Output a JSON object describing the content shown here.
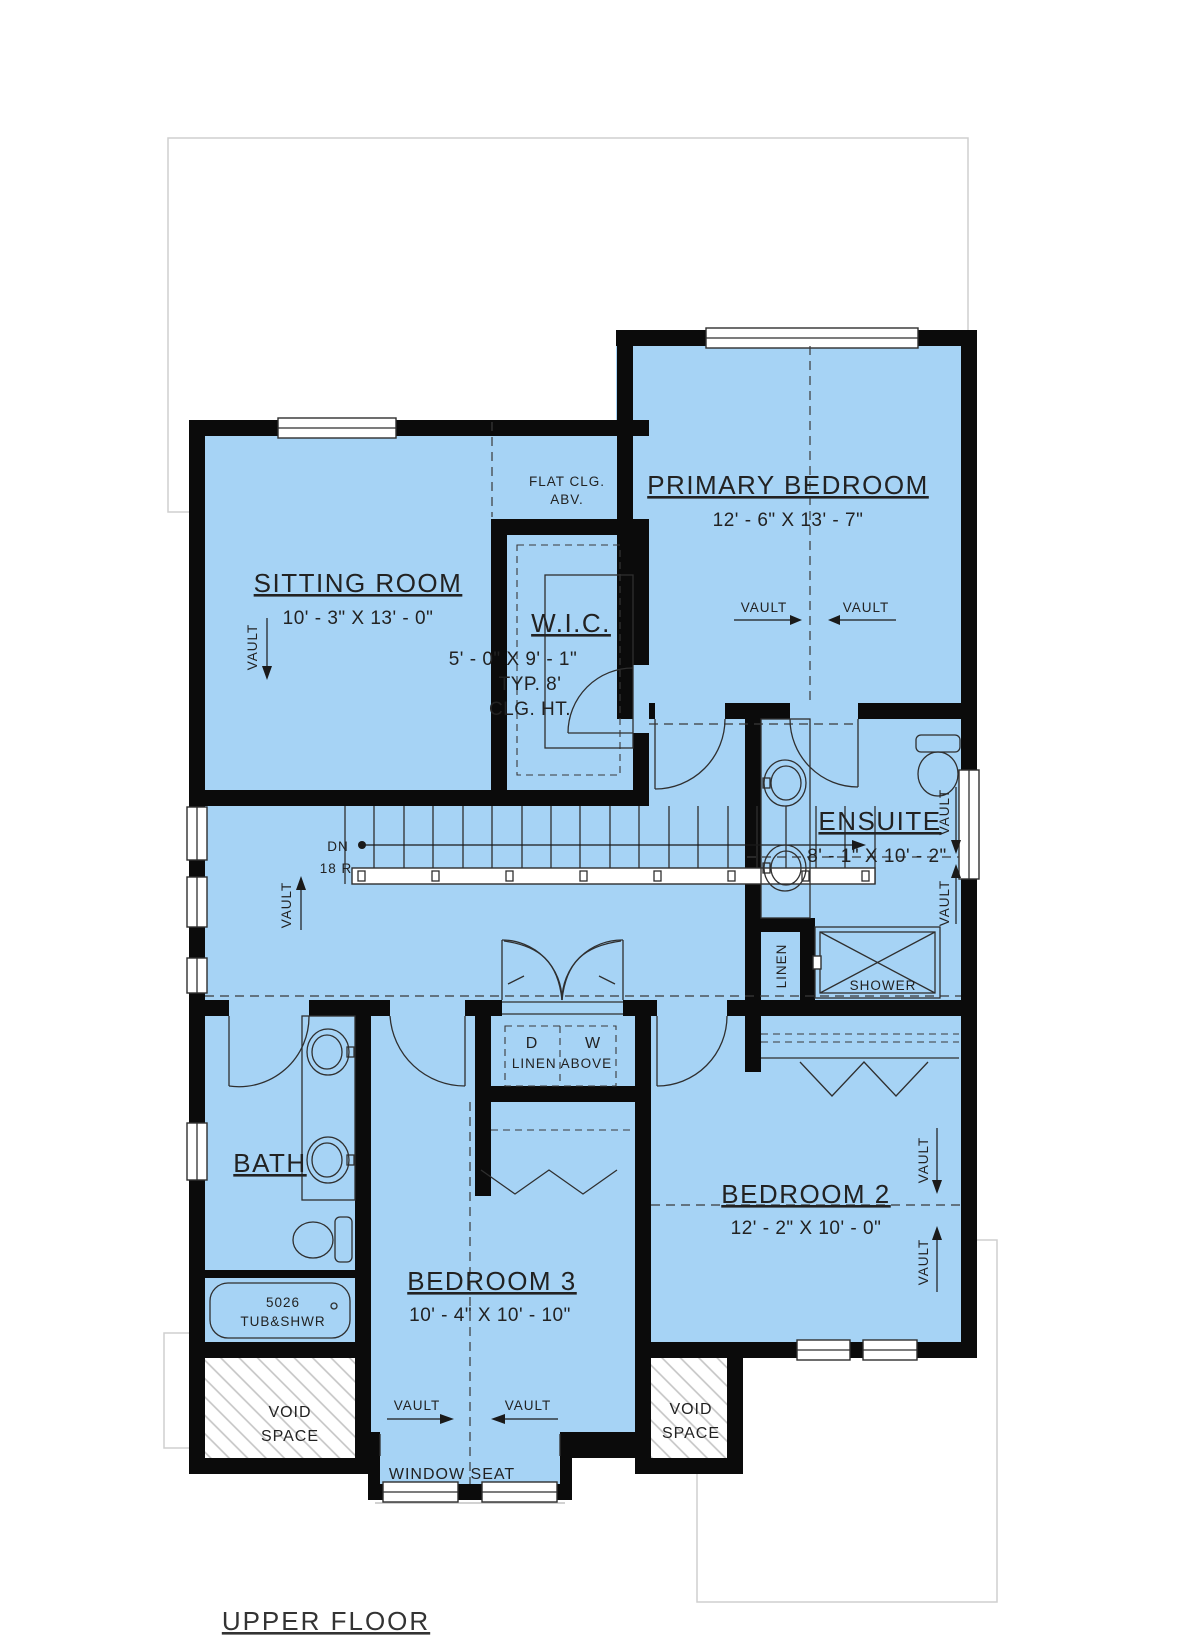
{
  "plan": {
    "title": "UPPER FLOOR",
    "rooms": {
      "sitting": {
        "name": "SITTING ROOM",
        "dims": "10' - 3\" X 13' - 0\""
      },
      "primary": {
        "name": "PRIMARY BEDROOM",
        "dims": "12' - 6\" X 13' - 7\""
      },
      "wic": {
        "name": "W.I.C.",
        "dims": "5' - 0\" X 9' - 1\"",
        "note1": "TYP. 8'",
        "note2": "CLG. HT."
      },
      "ensuite": {
        "name": "ENSUITE",
        "dims": "8' - 1\" X 10' - 2\""
      },
      "bath": {
        "name": "BATH"
      },
      "bedroom2": {
        "name": "BEDROOM 2",
        "dims": "12' - 2\" X 10' - 0\""
      },
      "bedroom3": {
        "name": "BEDROOM 3",
        "dims": "10' - 4\" X 10' - 10\""
      }
    },
    "labels": {
      "flat_clg_1": "FLAT CLG.",
      "flat_clg_2": "ABV.",
      "vault": "VAULT",
      "dn": "DN",
      "risers": "18 R",
      "linen": "LINEN",
      "shower": "SHOWER",
      "dryer": "D",
      "washer": "W",
      "linen_above": "LINEN ABOVE",
      "tub_model": "5026",
      "tub_type": "TUB&SHWR",
      "void_1": "VOID",
      "void_2": "SPACE",
      "window_seat": "WINDOW SEAT"
    },
    "colors": {
      "floor": "#a6d3f5",
      "wall": "#0b0b0b",
      "outline": "#cfcfcf",
      "hatch": "#c4c4c4",
      "text": "#222222"
    }
  }
}
